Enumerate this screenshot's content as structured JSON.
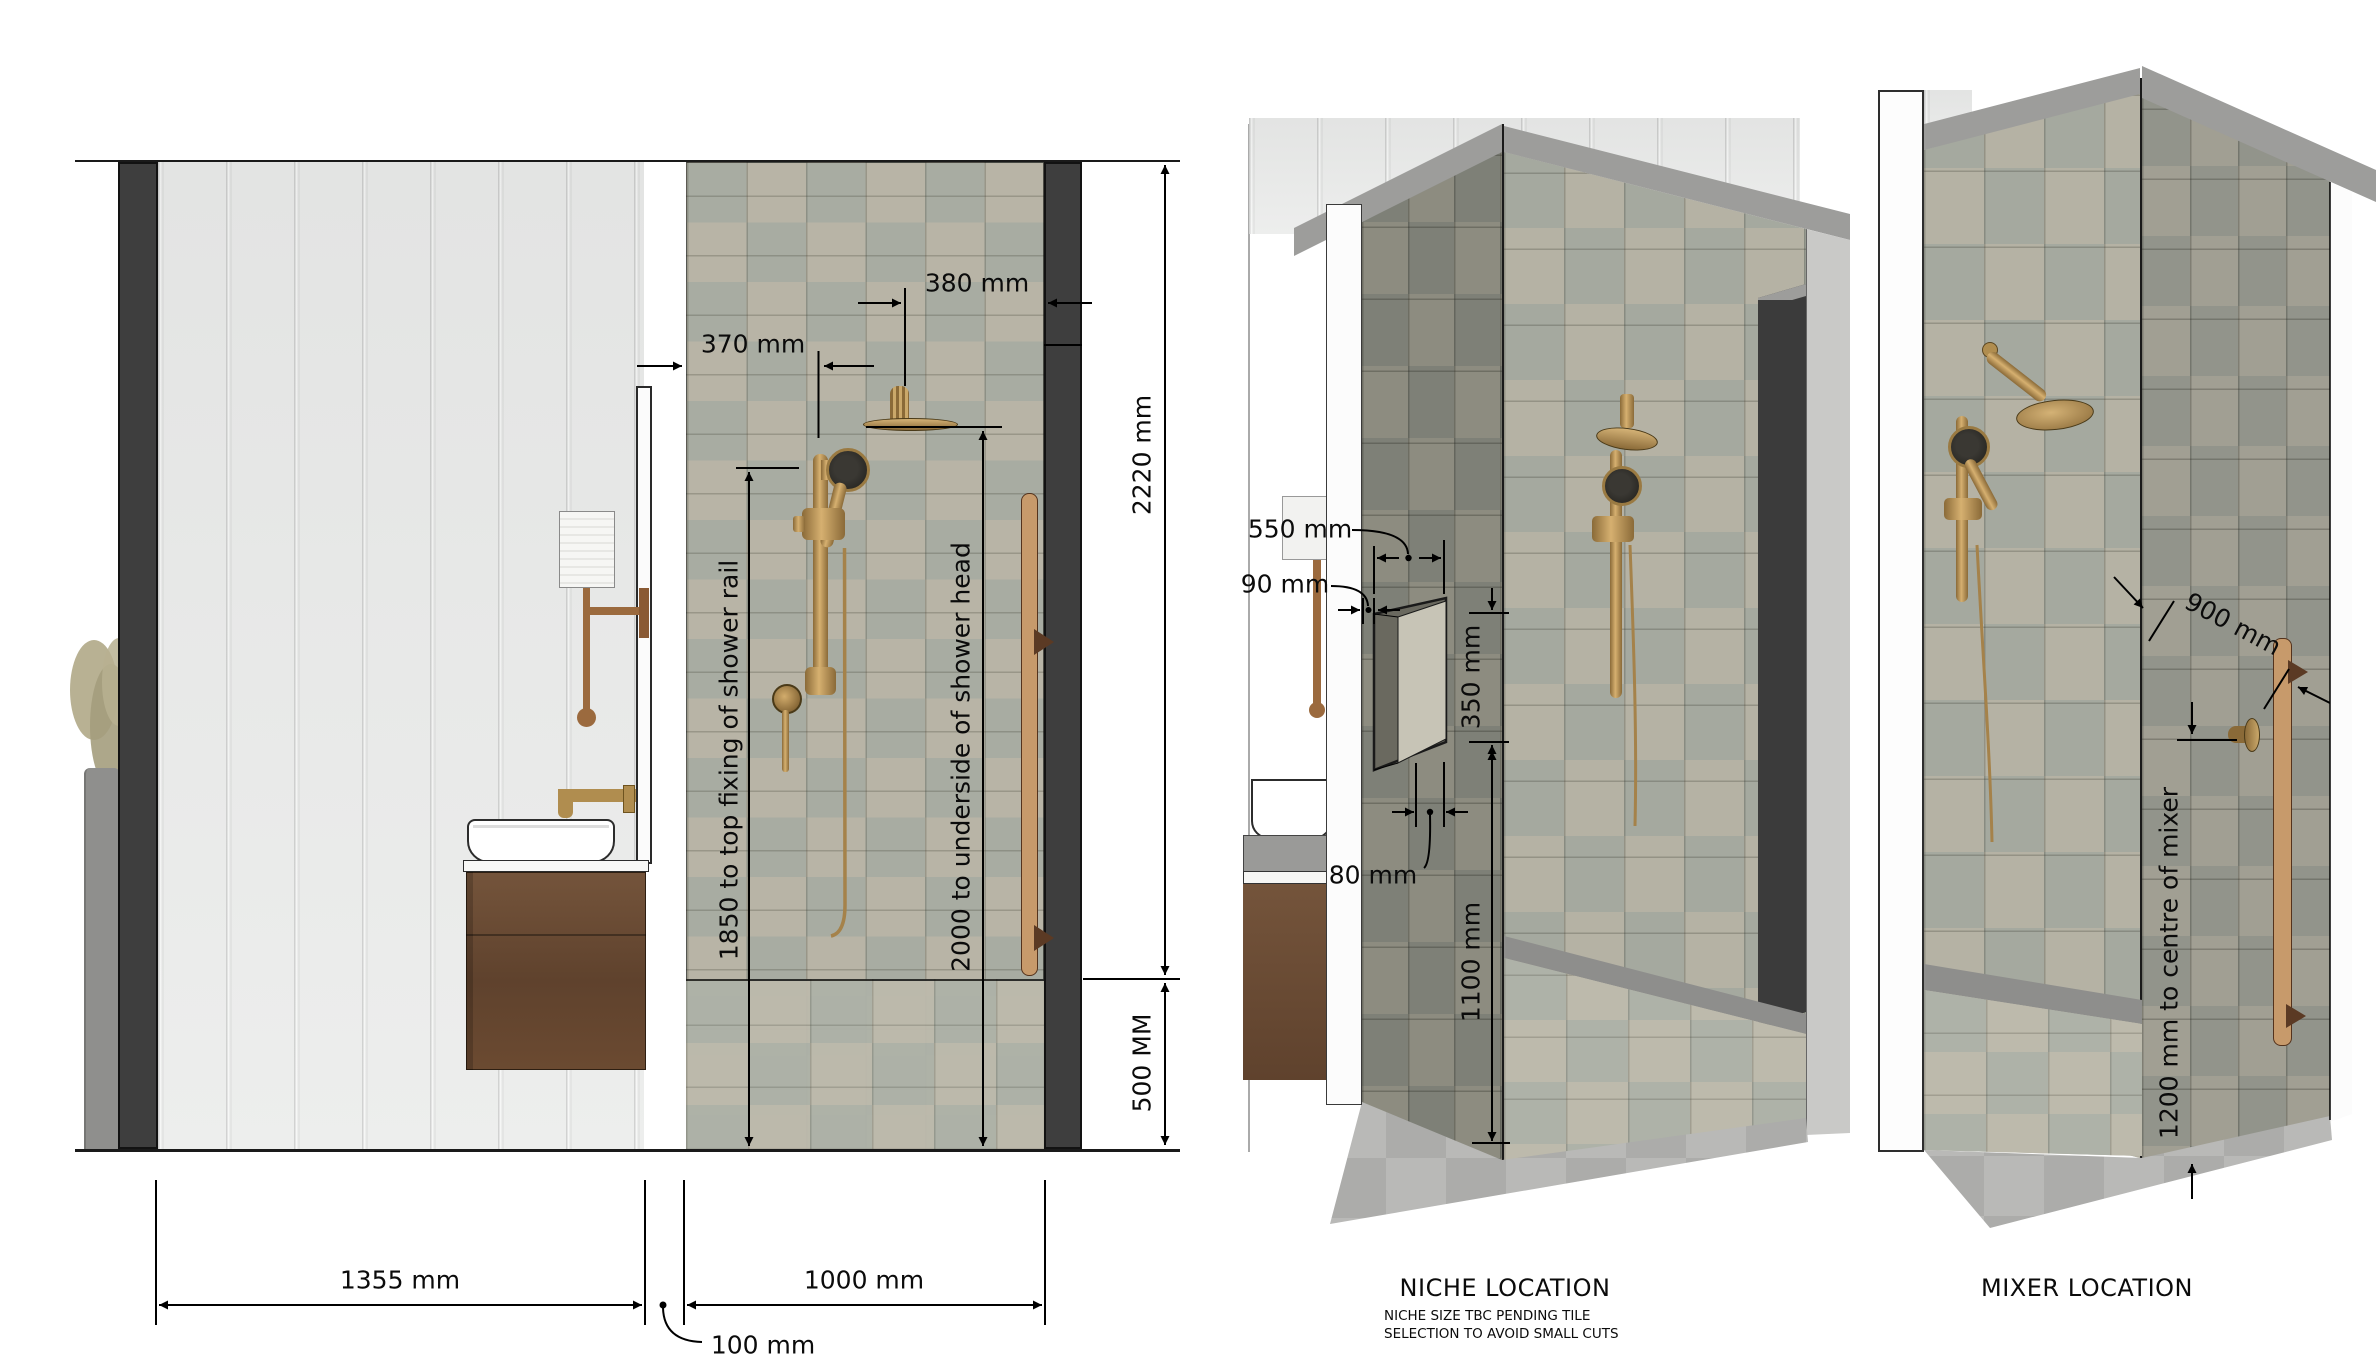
{
  "elevation": {
    "dim_rail_offset": "370 mm",
    "dim_head_offset": "380 mm",
    "dim_wall_height": "2220 mm",
    "dim_hob_height": "500 MM",
    "dim_vanity_wall": "1355 mm",
    "dim_shower_wall": "1000 mm",
    "dim_gap": "100 mm",
    "dim_rail_fixing": "1850 to top fixing of shower rail",
    "dim_head_underside": "2000 to underside of shower head"
  },
  "niche": {
    "title": "NICHE LOCATION",
    "note1": "NICHE SIZE TBC PENDING TILE",
    "note2": "SELECTION TO AVOID SMALL CUTS",
    "dim_width": "550 mm",
    "dim_offset": "90 mm",
    "dim_height": "350 mm",
    "dim_corner": "80 mm",
    "dim_floor": "1100 mm"
  },
  "mixer": {
    "title": "MIXER LOCATION",
    "dim_rail": "900 mm",
    "dim_mixer": "1200 mm to centre of mixer"
  },
  "colors": {
    "feature_wall": "#3e3e3e",
    "tile_a": "#b8b4a6",
    "tile_b": "#a8aca2",
    "brass": "#b3905a",
    "timber_rail": "#c79a6b",
    "walnut": "#6e4c36"
  }
}
